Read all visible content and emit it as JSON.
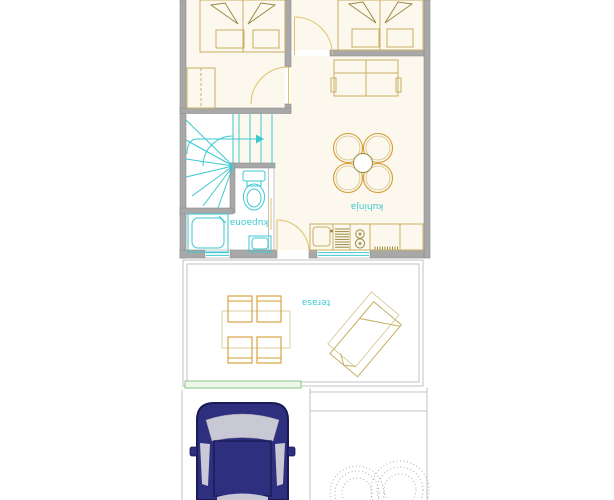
{
  "labels": {
    "bathroom": "kupaona",
    "kitchen": "kuhinja",
    "terrace": "terasa"
  },
  "colors": {
    "wall": "#a8a8a8",
    "wallEdge": "#8d8d8d",
    "roomFill": "#fcf8ee",
    "furn": "#c7af63",
    "furnDark": "#9c8a42",
    "orange": "#d59b2f",
    "door": "#dcc265",
    "cyan": "#3bc9d1",
    "green": "#85c687",
    "greenFill": "#eef7ea",
    "line": "#b3b3b3",
    "carBody": "#2f2f80",
    "carTrim": "#1a1a55",
    "carWindow": "#c9c9d6",
    "bush": "#9a9a9a"
  }
}
